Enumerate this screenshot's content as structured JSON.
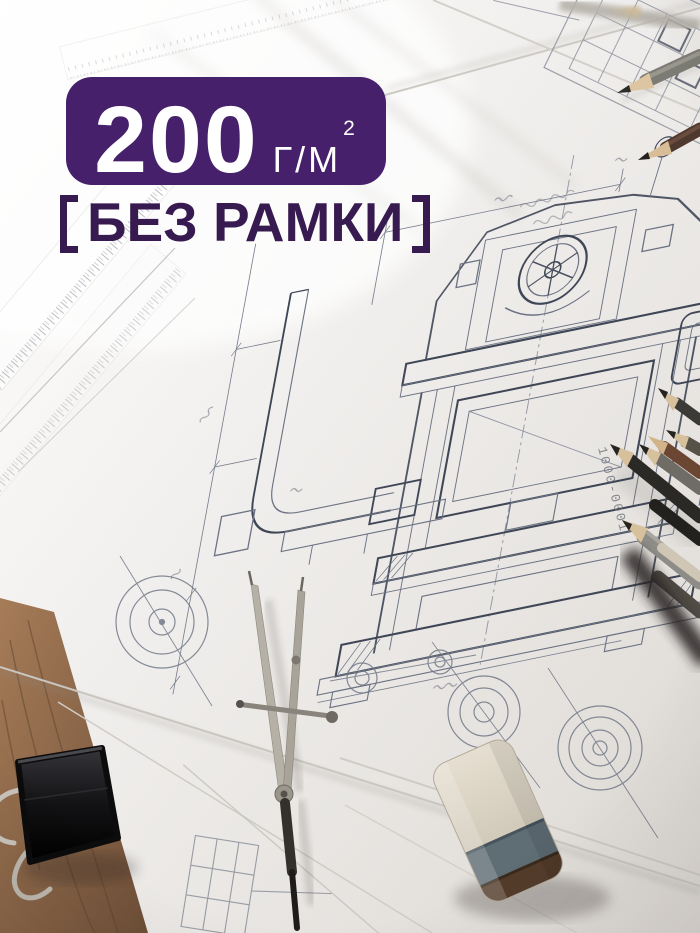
{
  "overlay": {
    "badge": {
      "value": "200",
      "unit": "Г/М",
      "superscript": "2"
    },
    "subtitle": {
      "label": "БЕЗ РАМКИ"
    }
  },
  "photo": {
    "annotation_vertical": "1000-0001",
    "objects": [
      "blueprint-technical-drawing",
      "graphite-pencils",
      "drafting-compass-divider",
      "binder-clip",
      "eraser",
      "transparent-ruler",
      "wooden-desk"
    ]
  },
  "colors": {
    "badge_bg": "#46206B",
    "badge_text": "#FFFFFF",
    "subtitle_text": "#371A50",
    "paper": "#F0EEEB",
    "blueprint_line": "#6B7282",
    "wood": "#8F6B4C",
    "eraser_band": "#5F6D75",
    "eraser_body": "#D9D2C2",
    "eraser_base": "#543C2B"
  }
}
